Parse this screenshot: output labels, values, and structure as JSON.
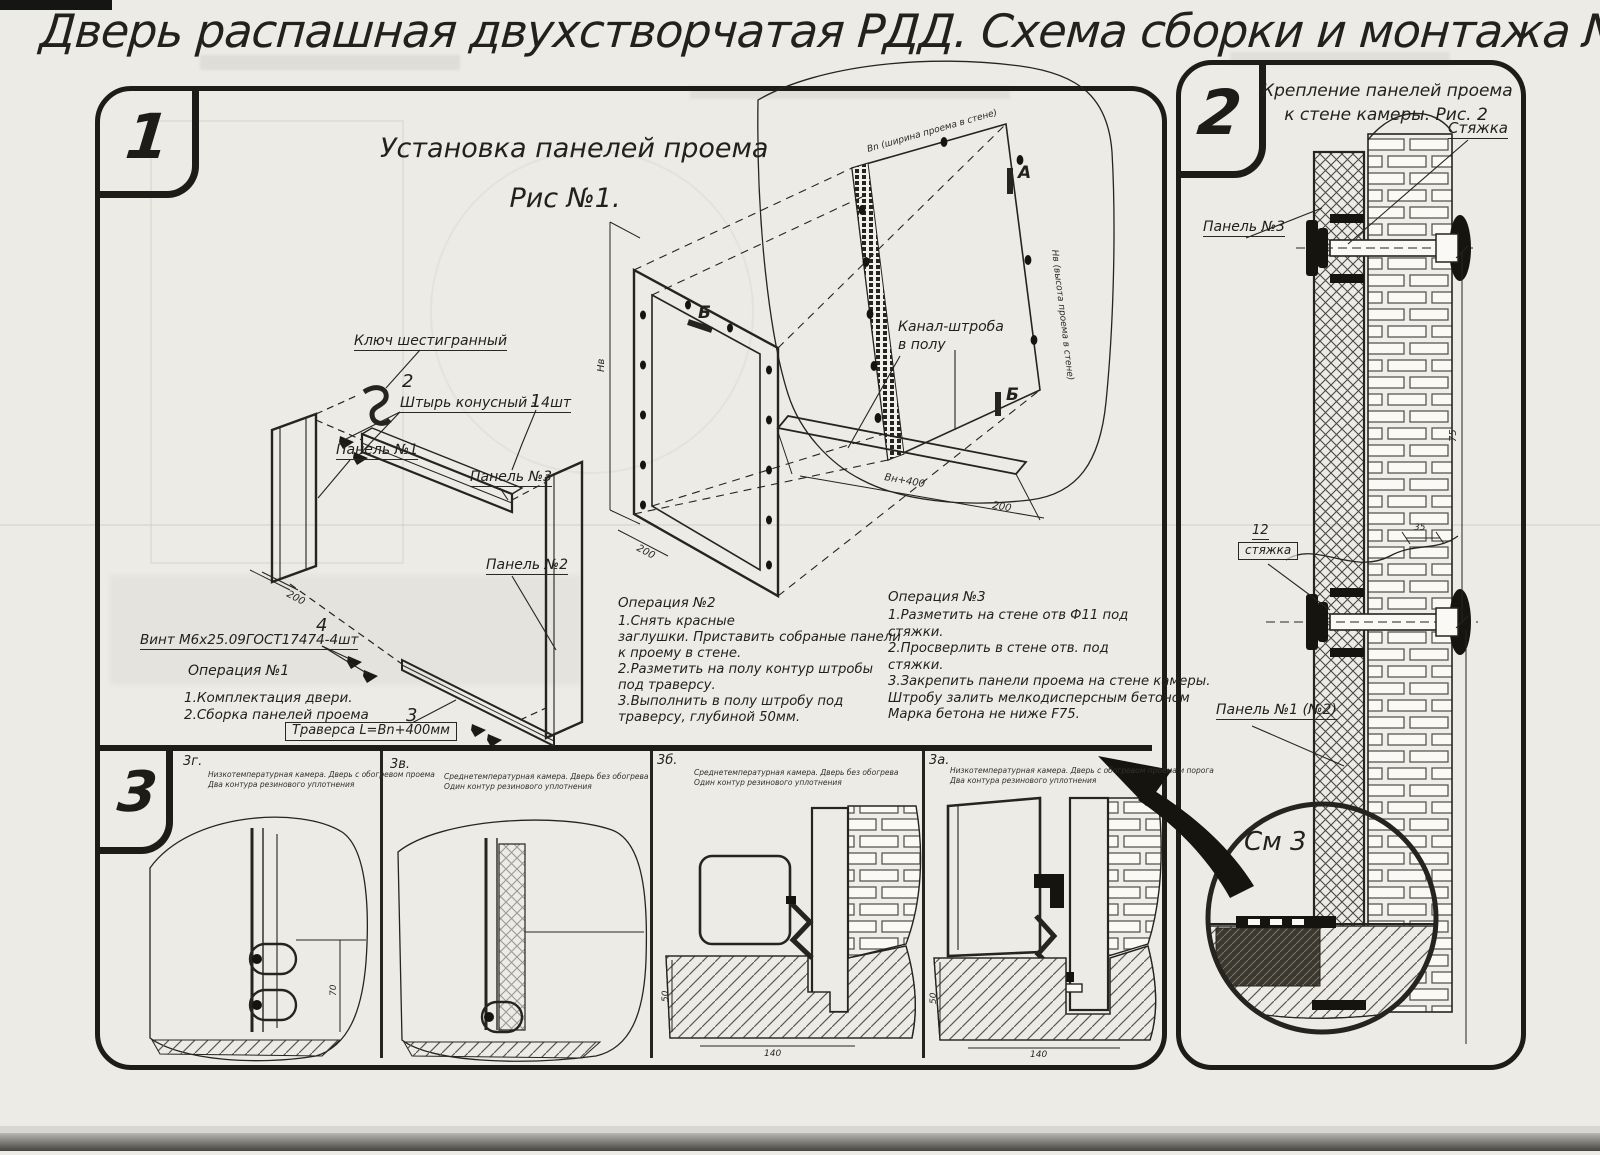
{
  "page": {
    "title": "Дверь распашная двухстворчатая РДД.  Схема сборки и монтажа №2"
  },
  "fig1": {
    "badge": "1",
    "title1": "Установка панелей проема",
    "title2": "Рис №1.",
    "labels": {
      "hexkey": "Ключ шестигранный",
      "pin": "Штырь конусный - 4шт",
      "panel3": "Панель №3",
      "panel1": "Панель №1",
      "panel2": "Панель №2",
      "screw": "Винт М6х25.09ГОСТ17474-4шт",
      "traverse": "Траверса  L=Bn+400мм",
      "channel1": "Канал-штроба",
      "channel2": "в полу",
      "c1": "1",
      "c2": "2",
      "c3": "3",
      "c4": "4",
      "secA": "А",
      "secB": "Б"
    },
    "dims": {
      "d200a": "200",
      "d200b": "200",
      "d200c": "200",
      "dbn400": "Вн+400",
      "dnv": "Нв",
      "dwidth": "Вn (ширина проема в стене)",
      "dheight": "Нв (высота проема в стене)"
    },
    "op1": {
      "title": "Операция №1",
      "lines": [
        "1.Комплектация двери.",
        "2.Сборка панелей проема"
      ]
    },
    "op2": {
      "title": "Операция №2",
      "lines": [
        "1.Снять красные",
        "заглушки. Приставить собраные панели",
        "к проему в стене.",
        "2.Разметить на полу контур штробы",
        "под траверсу.",
        "3.Выполнить в полу штробу под",
        "траверсу, глубиной 50мм."
      ]
    },
    "op3": {
      "title": "Операция №3",
      "lines": [
        "1.Разметить на стене отв Ф11 под",
        "стяжки.",
        "2.Просверлить в стене отв.  под",
        "стяжки.",
        "3.Закрепить панели проема на стене камеры.",
        "Штробу залить мелкодисперсным бетоном",
        "Марка бетона не ниже  F75."
      ]
    }
  },
  "fig2": {
    "badge": "2",
    "title1": "Крепление панелей проема",
    "title2": "к стене камеры. Рис. 2",
    "labels": {
      "tie": "Стяжка",
      "panel3": "Панель №3",
      "tie_no": "12",
      "tie_boxed": "стяжка",
      "panel12": "Панель №1 (№2)",
      "see3": "См 3"
    },
    "dims": {
      "d75": "75",
      "d35": "35"
    }
  },
  "section3": {
    "badge": "3",
    "items": [
      {
        "label": "3г.",
        "cap1": "Низкотемпературная камера. Дверь с обогревом проема",
        "cap2": "Два контура резинового уплотнения"
      },
      {
        "label": "3в.",
        "cap1": "Среднетемпературная камера. Дверь без обогрева",
        "cap2": "Один контур резинового уплотнения"
      },
      {
        "label": "3б.",
        "cap1": "Среднетемпературная камера. Дверь без обогрева",
        "cap2": "Один контур резинового уплотнения"
      },
      {
        "label": "3а.",
        "cap1": "Низкотемпературная камера. Дверь с обогревом проема и порога",
        "cap2": "Два контура резинового уплотнения"
      }
    ],
    "dims": {
      "d70": "70",
      "d50": "50",
      "d140": "140"
    }
  }
}
